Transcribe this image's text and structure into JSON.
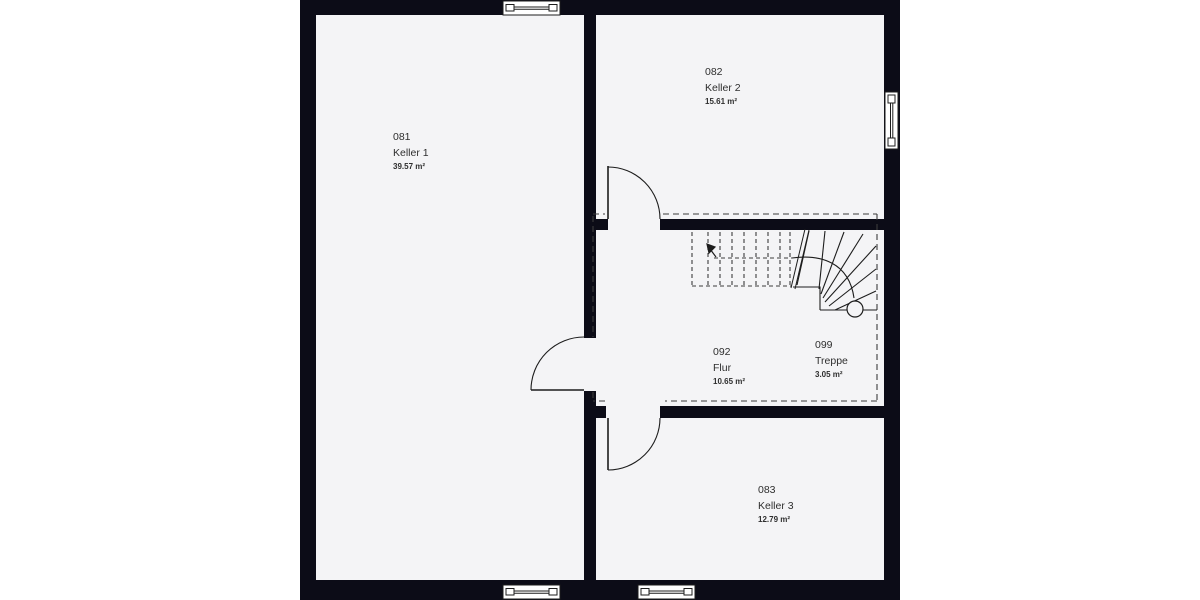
{
  "plan": {
    "floor_label": "Kellergeschoss",
    "colors": {
      "canvas_background": "#ffffff",
      "wall_dark": "#0c0c17",
      "room_fill": "#f4f4f6",
      "line": "#1d1d1d",
      "dashed_line": "#3c3c3c",
      "text": "#2e2e2e"
    },
    "rooms": [
      {
        "id": "081",
        "name": "Keller 1",
        "area": "39.57 m²"
      },
      {
        "id": "082",
        "name": "Keller 2",
        "area": "15.61 m²"
      },
      {
        "id": "092",
        "name": "Flur",
        "area": "10.65 m²"
      },
      {
        "id": "099",
        "name": "Treppe",
        "area": "3.05 m²"
      },
      {
        "id": "083",
        "name": "Keller 3",
        "area": "12.79 m²"
      }
    ],
    "windows": [
      {
        "position": "top-wall"
      },
      {
        "position": "right-wall"
      },
      {
        "position": "bottom-wall-left"
      },
      {
        "position": "bottom-wall-right"
      }
    ],
    "doors": [
      {
        "between": "Flur / Keller 2"
      },
      {
        "between": "Keller 1 / Flur"
      },
      {
        "between": "Flur / Keller 3"
      }
    ],
    "stair": {
      "type": "quarter-turn winder stair",
      "room_id": "099"
    }
  }
}
